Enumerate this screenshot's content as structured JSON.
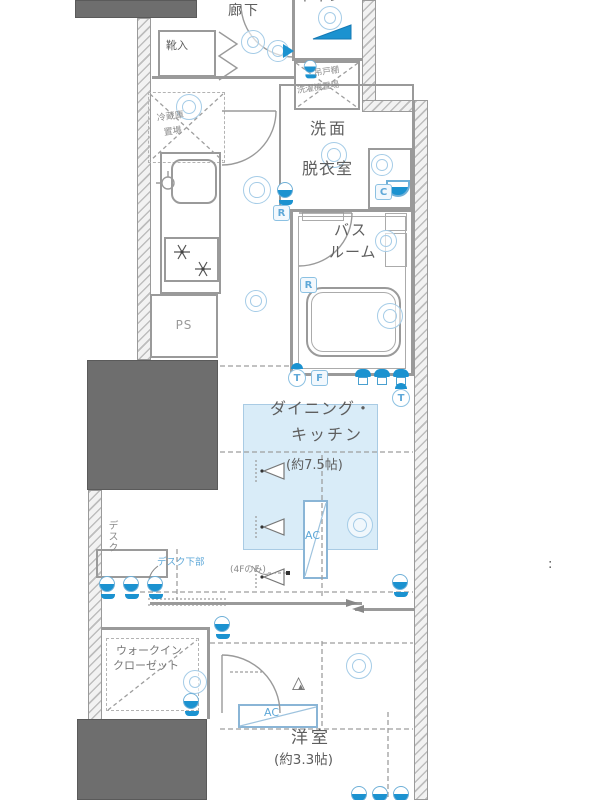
{
  "colors": {
    "accent_blue": "#1b92d0",
    "light_blue_fill": "#cfe4f4",
    "redaction_gray": "#6e6e6e"
  },
  "labels": {
    "hallway": "廊下",
    "shoe_cabinet": "靴入",
    "toilet": "トイレ",
    "hanging_cupboard": "吊戸棚",
    "washer_space": "洗濯機置場",
    "fridge_line1": "冷蔵庫",
    "fridge_line2": "置場",
    "washroom_line1": "洗面",
    "washroom_line2": "脱衣室",
    "bath_line1": "バス",
    "bath_line2": "ルーム",
    "pipe_space": "PS",
    "dk_line1": "ダイニング・",
    "dk_line2": "キッチン",
    "dk_size": "(約7.5帖)",
    "ac": "AC",
    "floor_note": "(4Fのみ)",
    "desk": "デスク",
    "desk_under": "デスク下部",
    "wic_line1": "ウォークイン",
    "wic_line2": "クローゼット",
    "bedroom": "洋室",
    "bedroom_size": "(約3.3帖)"
  },
  "badges": {
    "r": "R",
    "c": "C",
    "f": "F",
    "t": "T"
  },
  "icons": {
    "vent_outer": "△",
    "vent_inner": "▲"
  },
  "margin_mark": ":"
}
